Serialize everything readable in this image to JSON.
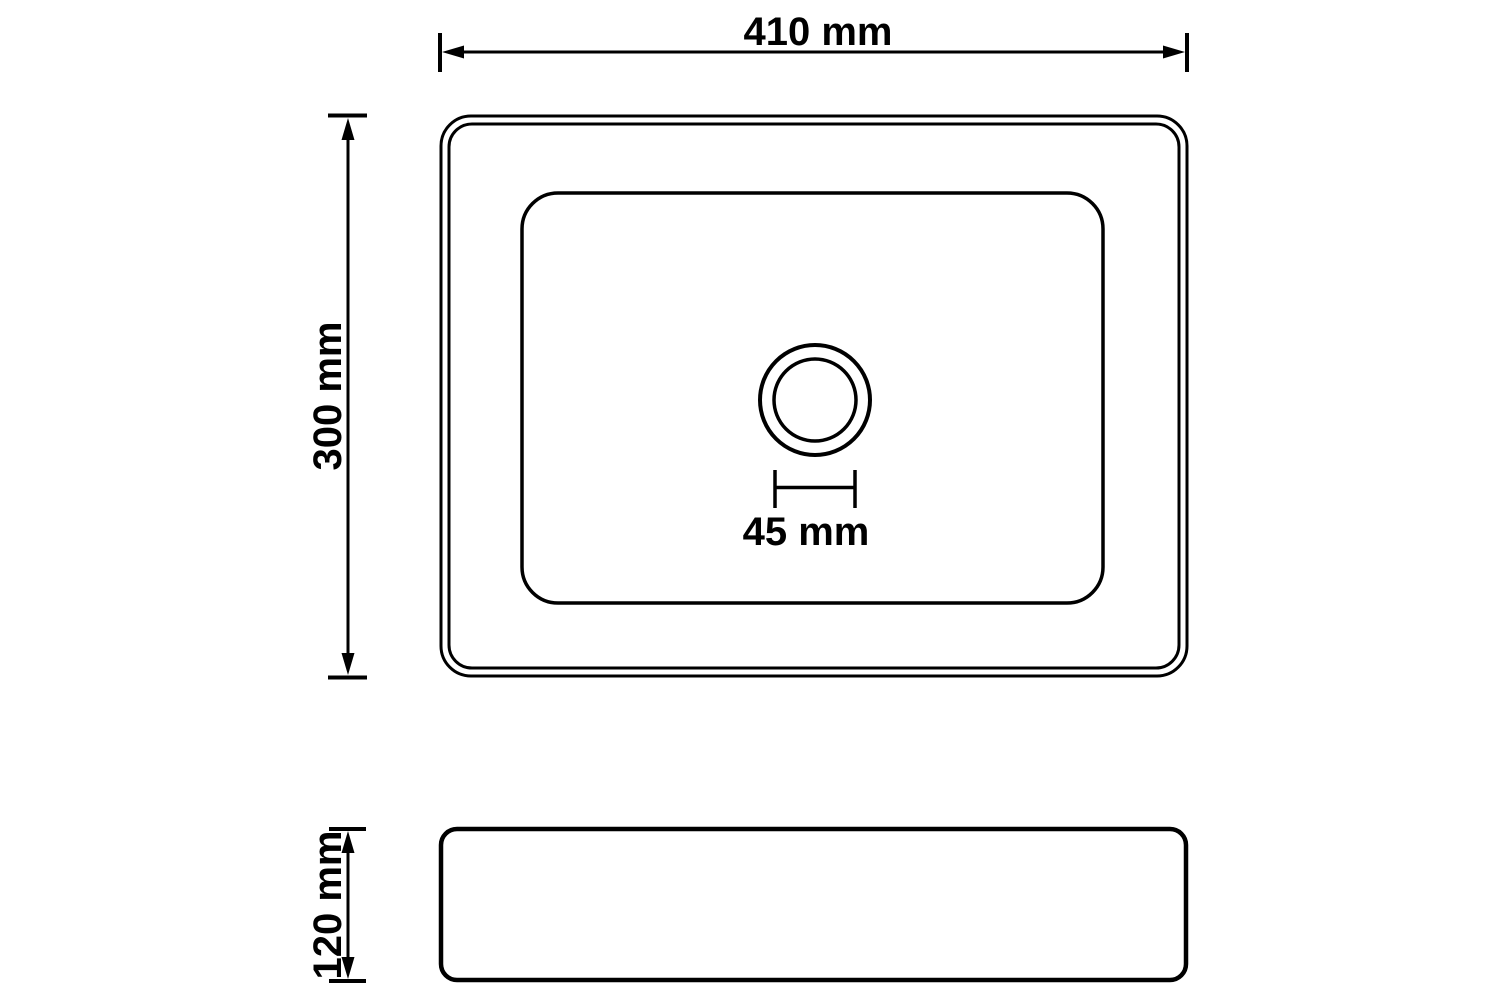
{
  "drawing": {
    "type": "technical-drawing",
    "subject": "rectangular washbasin with drain hole, top view and side view",
    "colors": {
      "line": "#000000",
      "background": "#ffffff"
    },
    "top_view": {
      "width_label": "410 mm",
      "depth_label": "300 mm",
      "drain_label": "45 mm"
    },
    "side_view": {
      "height_label": "120 mm"
    }
  }
}
